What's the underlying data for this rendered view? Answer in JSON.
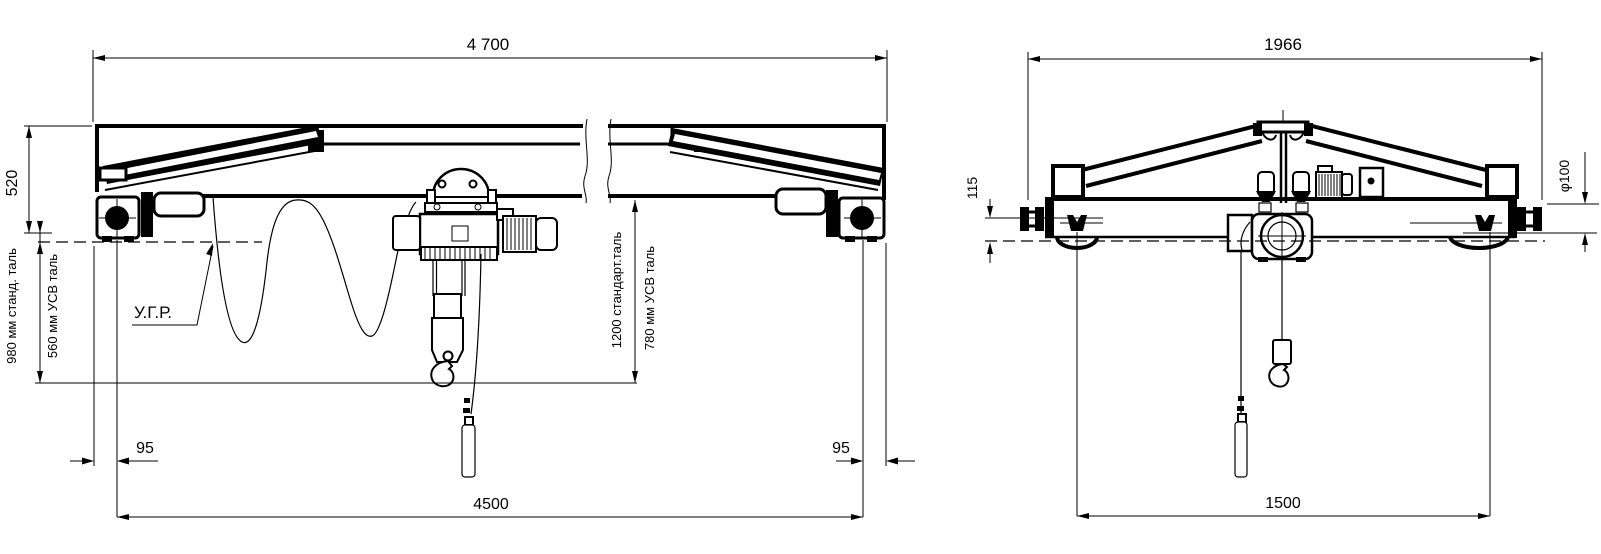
{
  "drawing": {
    "left_view": {
      "dim_span_top": "4 700",
      "dim_girder_height": "520",
      "dim_hook_std": "980 мм станд. таль",
      "dim_hook_usv": "560 мм УСВ таль",
      "rail_level_label": "У.Г.Р.",
      "dim_hoist_std": "1200 стандарт.таль",
      "dim_hoist_usv": "780 мм УСВ таль",
      "dim_wheel_offset_left": "95",
      "dim_wheel_offset_right": "95",
      "dim_span_wheels": "4500"
    },
    "right_view": {
      "dim_width_top": "1966",
      "dim_rail_clearance": "115",
      "dim_wheel_diameter": "φ100",
      "dim_wheel_base": "1500"
    }
  }
}
